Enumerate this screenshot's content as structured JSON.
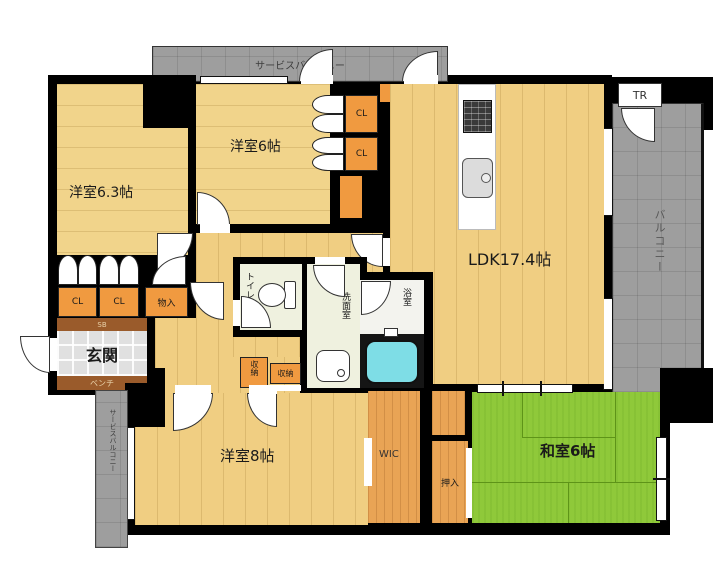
{
  "labels": {
    "service_balcony_top": "サービスバルコニー",
    "service_balcony_left": "サービスバルコニー",
    "room63": "洋室6.3帖",
    "room6": "洋室6帖",
    "ldk": "LDK17.4帖",
    "room8": "洋室8帖",
    "washitsu": "和室6帖",
    "genkan": "玄関",
    "toilet": "トイレ",
    "senmen": "洗面室",
    "bath": "浴室",
    "wic": "WIC",
    "oshiire": "押入",
    "monoire": "物入",
    "sb": "SB",
    "bench": "ベンチ",
    "tr": "TR",
    "balcony": "バルコニー",
    "cl": "CL",
    "shuno": "収納"
  },
  "colors": {
    "wall": "#000000",
    "floor_wood": "#F1D48B",
    "floor_wood_ldk": "#F0CE82",
    "closet_orange": "#F09A40",
    "wood_orange": "#E9A455",
    "tatami_green": "#8FC93A",
    "balcony_gray": "#9E9E9E",
    "entry_tile": "#E0E0E0",
    "bench_brown": "#9A5B2B",
    "bathtub_cyan": "#7EDDE6",
    "wet_room_pale": "#EFF1DF"
  }
}
